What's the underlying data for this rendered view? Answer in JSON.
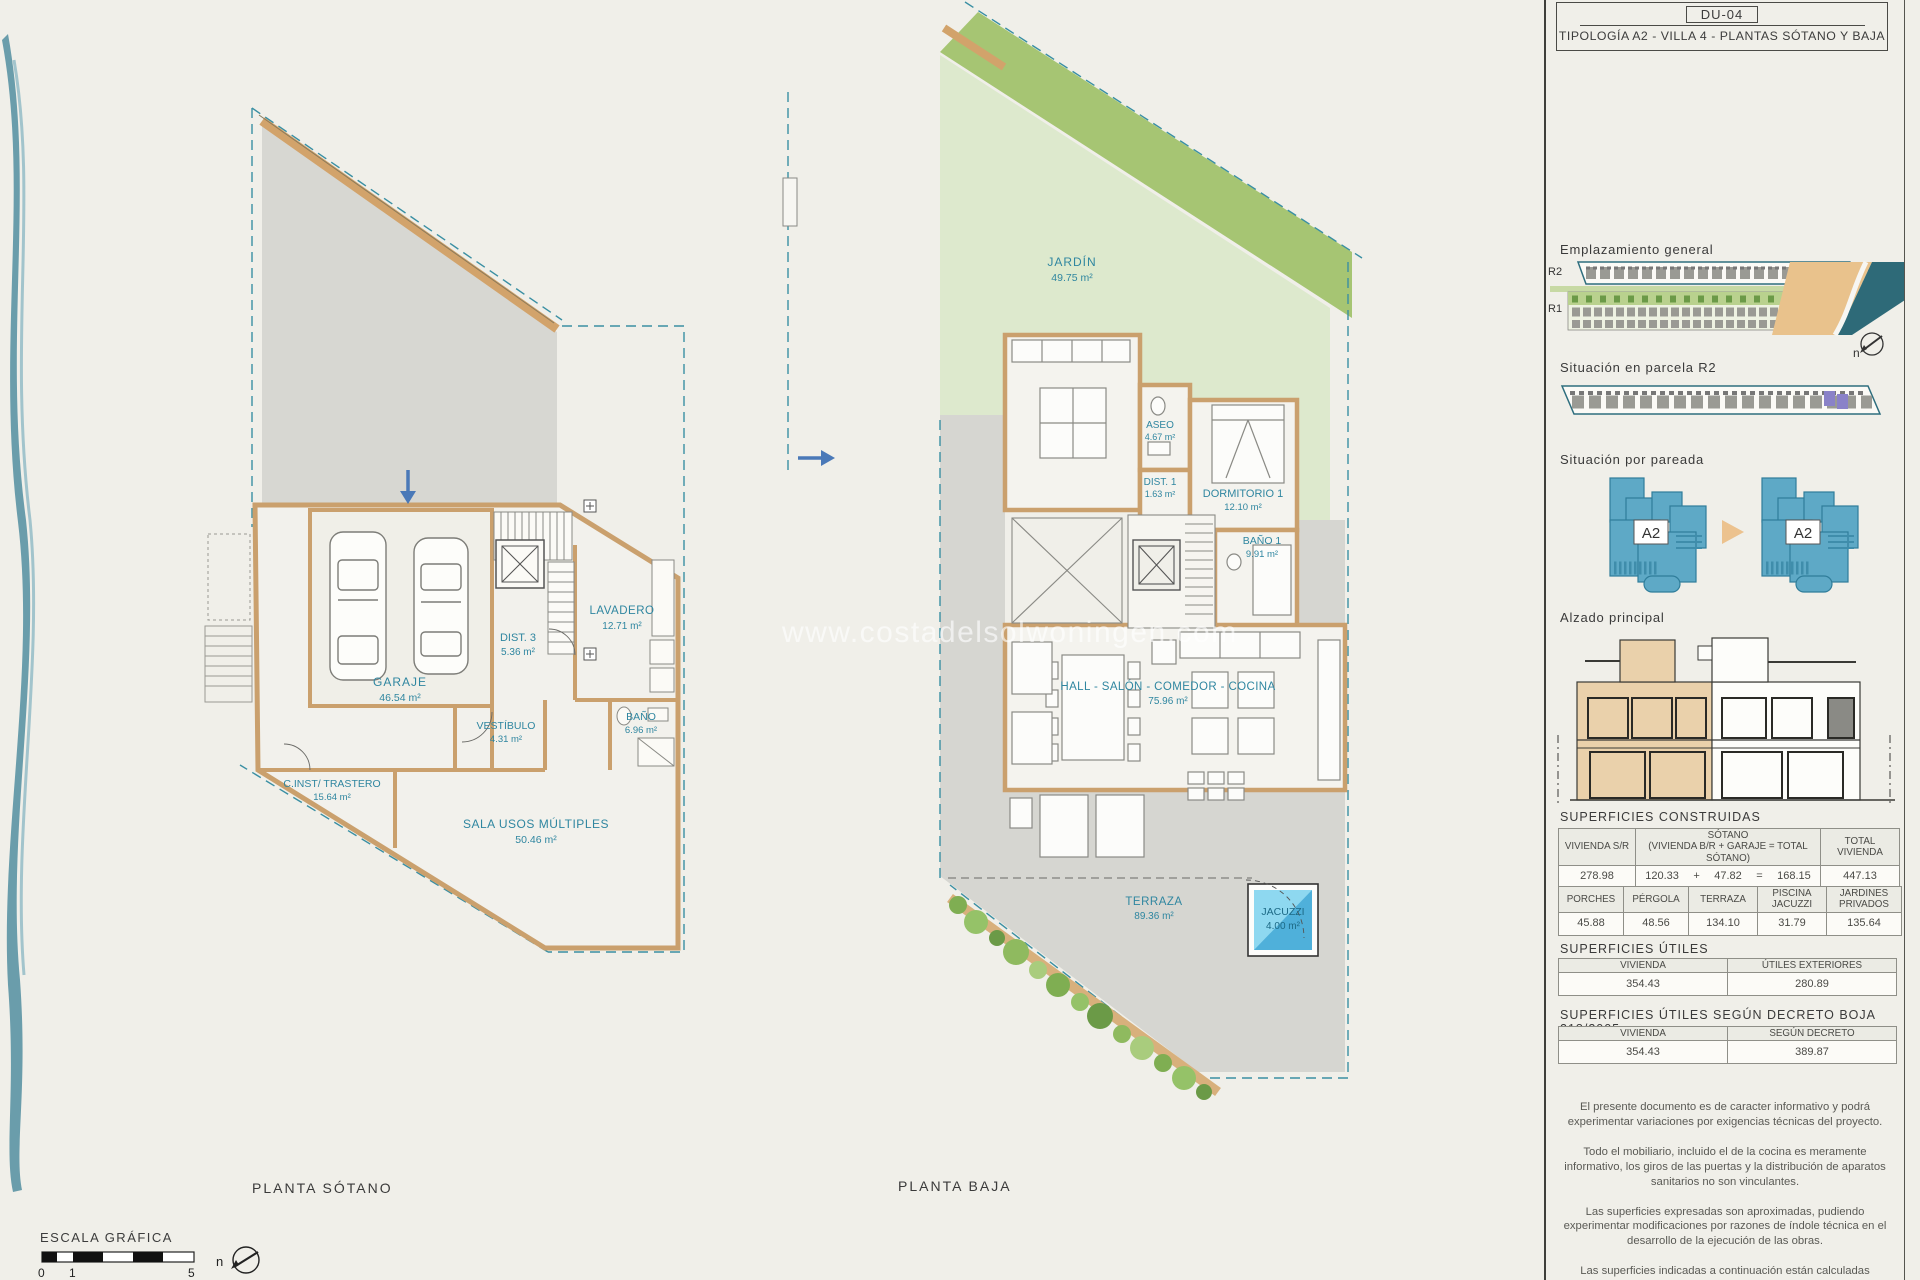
{
  "watermark": "www.costadelsolwoningen.com",
  "title_block": {
    "code": "DU-04",
    "title": "TIPOLOGÍA A2 - VILLA 4 - PLANTAS SÓTANO Y BAJA"
  },
  "plans": {
    "sotano": {
      "caption": "PLANTA SÓTANO",
      "rooms": {
        "garaje": {
          "name": "GARAJE",
          "area": "46.54 m²"
        },
        "dist3": {
          "name": "DIST. 3",
          "area": "5.36 m²"
        },
        "lavadero": {
          "name": "LAVADERO",
          "area": "12.71 m²"
        },
        "vestibulo": {
          "name": "VESTÍBULO",
          "area": "4.31 m²"
        },
        "bano": {
          "name": "BAÑO",
          "area": "6.96 m²"
        },
        "trastero": {
          "name": "C.INST/ TRASTERO",
          "area": "15.64 m²"
        },
        "sala": {
          "name": "SALA USOS MÚLTIPLES",
          "area": "50.46 m²"
        }
      }
    },
    "baja": {
      "caption": "PLANTA BAJA",
      "rooms": {
        "jardin": {
          "name": "JARDÍN",
          "area": "49.75 m²"
        },
        "aseo": {
          "name": "ASEO",
          "area": "4.67 m²"
        },
        "dist1": {
          "name": "DIST. 1",
          "area": "1.63 m²"
        },
        "dorm1": {
          "name": "DORMITORIO 1",
          "area": "12.10 m²"
        },
        "bano1": {
          "name": "BAÑO 1",
          "area": "9.91 m²"
        },
        "salon": {
          "name": "HALL - SALÓN - COMEDOR - COCINA",
          "area": "75.96 m²"
        },
        "terraza": {
          "name": "TERRAZA",
          "area": "89.36 m²"
        },
        "jacuzzi": {
          "name": "JACUZZI",
          "area": "4.00 m²"
        }
      }
    }
  },
  "sidebar": {
    "emplazamiento": {
      "title": "Emplazamiento general",
      "r2": "R2",
      "r1": "R1",
      "north": "n"
    },
    "parcela": {
      "title": "Situación en parcela R2"
    },
    "pareada": {
      "title": "Situación por pareada",
      "unit": "A2"
    },
    "alzado": {
      "title": "Alzado principal"
    },
    "construidas": {
      "title": "SUPERFICIES CONSTRUIDAS",
      "t1": {
        "col1": "VIVIENDA S/R",
        "col2a": "SÓTANO",
        "col2b": "(VIVIENDA B/R + GARAJE = TOTAL SÓTANO)",
        "col3": "TOTAL VIVIENDA",
        "v1": "278.98",
        "v2a": "120.33",
        "plus": "+",
        "v2b": "47.82",
        "eq": "=",
        "v2c": "168.15",
        "v3": "447.13"
      },
      "t2": {
        "h": [
          "PORCHES",
          "PÉRGOLA",
          "TERRAZA",
          "PISCINA JACUZZI",
          "JARDINES PRIVADOS"
        ],
        "v": [
          "45.88",
          "48.56",
          "134.10",
          "31.79",
          "135.64"
        ]
      }
    },
    "utiles": {
      "title": "SUPERFICIES ÚTILES",
      "h": [
        "VIVIENDA",
        "ÚTILES EXTERIORES"
      ],
      "v": [
        "354.43",
        "280.89"
      ]
    },
    "decreto": {
      "title": "SUPERFICIES ÚTILES SEGÚN DECRETO BOJA 218/2005",
      "h": [
        "VIVIENDA",
        "SEGÚN DECRETO"
      ],
      "v": [
        "354.43",
        "389.87"
      ]
    },
    "legal": [
      "El presente documento es de caracter informativo y podrá experimentar variaciones por exigencias técnicas del proyecto.",
      "Todo el mobiliario, incluido el de la cocina es meramente informativo, los giros de las puertas y la distribución de aparatos sanitarios no son vinculantes.",
      "Las superficies expresadas son aproximadas, pudiendo experimentar modificaciones por razones de índole técnica en el desarrollo de la ejecución de las obras.",
      "Las superficies indicadas a continuación están calculadas conforme al Decreto 218/2005 de información al consumidor en la compraventa y arrendamiento de viviendas de andalucía."
    ]
  },
  "footer": {
    "escala": "ESCALA GRÁFICA",
    "t0": "0",
    "t1": "1",
    "t5": "5",
    "north": "n"
  },
  "colors": {
    "teal_label": "#2f86a0",
    "wall_tan": "#cfa06b",
    "garden_light": "#dde9cd",
    "garden_dark": "#a6c573",
    "terrace_gray": "#d6d6d1",
    "jacuzzi_blue": "#6ec6e8",
    "unit_blue": "#5ea9c6",
    "sea": "#2e6a78",
    "sand": "#e9c28c",
    "highlight_purple": "#8a82c8"
  }
}
